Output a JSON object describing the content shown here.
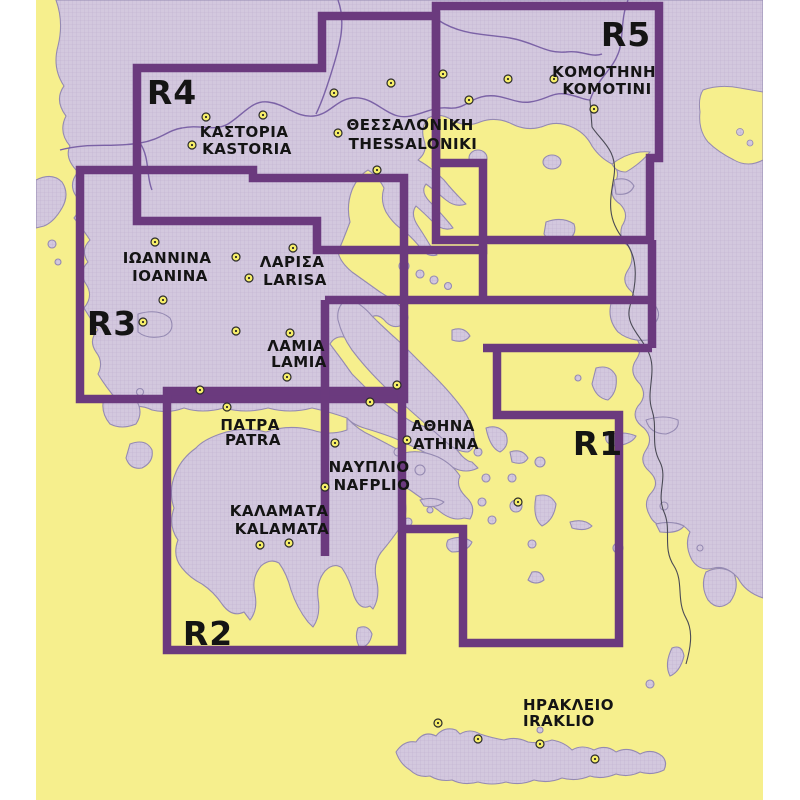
{
  "map": {
    "title": "Greece road-map sheet index",
    "regions": [
      {
        "id": "r1",
        "label": "R1"
      },
      {
        "id": "r2",
        "label": "R2"
      },
      {
        "id": "r3",
        "label": "R3"
      },
      {
        "id": "r4",
        "label": "R4"
      },
      {
        "id": "r5",
        "label": "R5"
      }
    ],
    "cities": [
      {
        "gr": "ΚΟΜΟΤΗΝΗ",
        "en": "KOMOTINI"
      },
      {
        "gr": "ΘΕΣΣΑΛΟΝΙΚΗ",
        "en": "THESSALONIKI"
      },
      {
        "gr": "ΚΑΣΤΟΡΙΑ",
        "en": "KASTORIA"
      },
      {
        "gr": "ΙΩΑΝΝΙΝΑ",
        "en": "ΙΟΑΝΙΝΑ"
      },
      {
        "gr": "ΛΑΡΙΣΑ",
        "en": "LARISA"
      },
      {
        "gr": "ΛΑΜΙΑ",
        "en": "LAMIA"
      },
      {
        "gr": "ΠΑΤΡΑ",
        "en": "PATRA"
      },
      {
        "gr": "ΑΘΗΝΑ",
        "en": "ATHINA"
      },
      {
        "gr": "ΝΑΥΠΛΙΟ",
        "en": "NAFPLIO"
      },
      {
        "gr": "ΚΑΛΑΜΑΤΑ",
        "en": "KALAMATA"
      },
      {
        "gr": "ΗΡΑΚΛΕΙΟ",
        "en": "IRAKLIO"
      }
    ],
    "colors": {
      "sea": "#f6ef8d",
      "land": "#d3c8de",
      "land_grid": "#b9a9cc",
      "sheet_border": "#6b3a7e",
      "country_border": "#7b62a6",
      "coastline": "#958ab2",
      "city_dot": "#f7ef6a",
      "label": "#141414"
    }
  }
}
